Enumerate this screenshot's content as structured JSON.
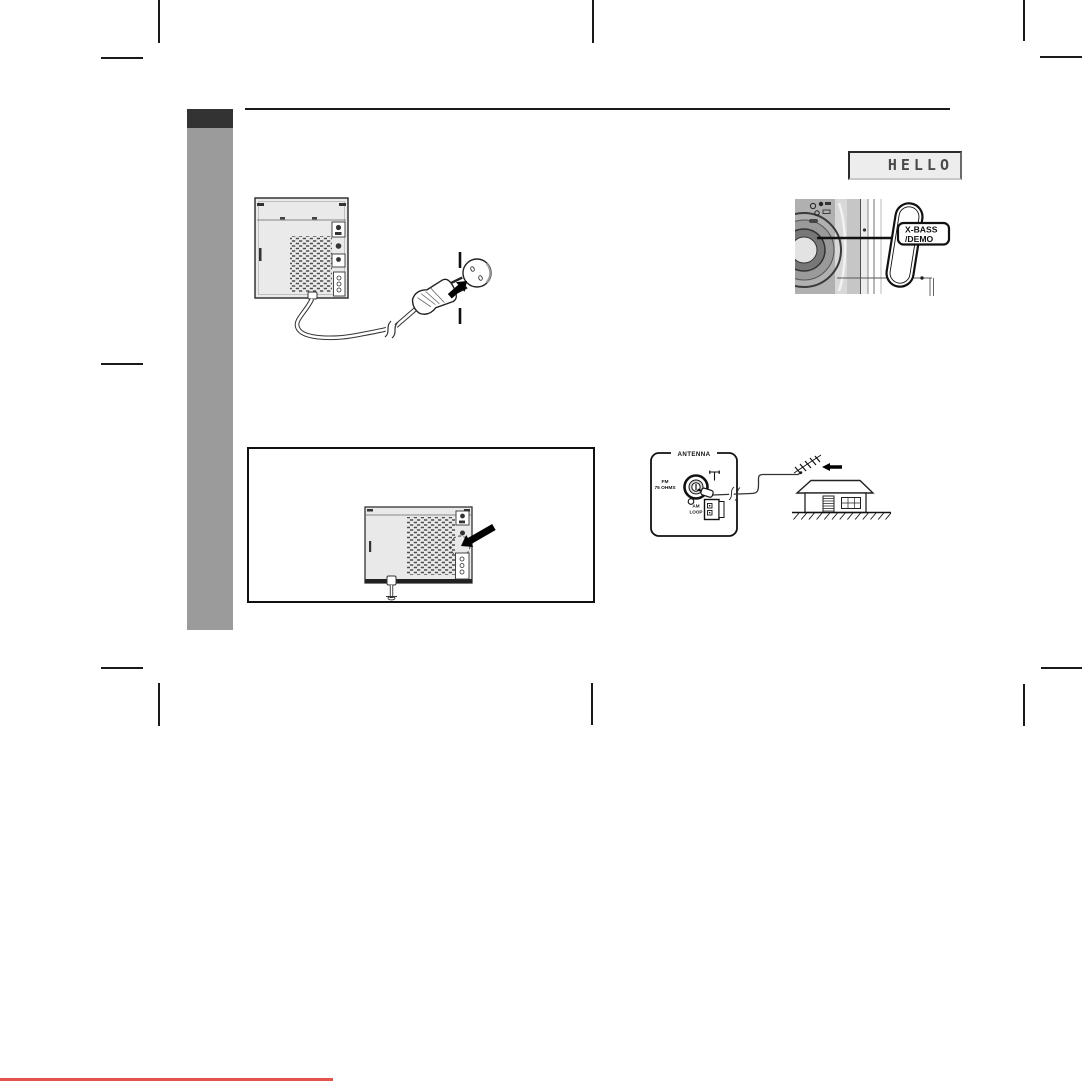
{
  "document": {
    "kind": "audio-system-owner-manual-page"
  },
  "display": {
    "text": "HELLO"
  },
  "xbass_button": {
    "line1": "X-BASS",
    "line2": "/DEMO"
  },
  "antenna_panel": {
    "title": "ANTENNA",
    "fm_line1": "FM",
    "fm_line2": "75 OHMS",
    "am_line1": "AM",
    "am_line2": "LOOP"
  },
  "colors": {
    "accent_red": "#e2544a",
    "sidebar_gray": "#9b9b9b",
    "sidebar_header": "#333333",
    "lcd_bg": "#ededed",
    "lcd_text": "#4a4a4a"
  }
}
